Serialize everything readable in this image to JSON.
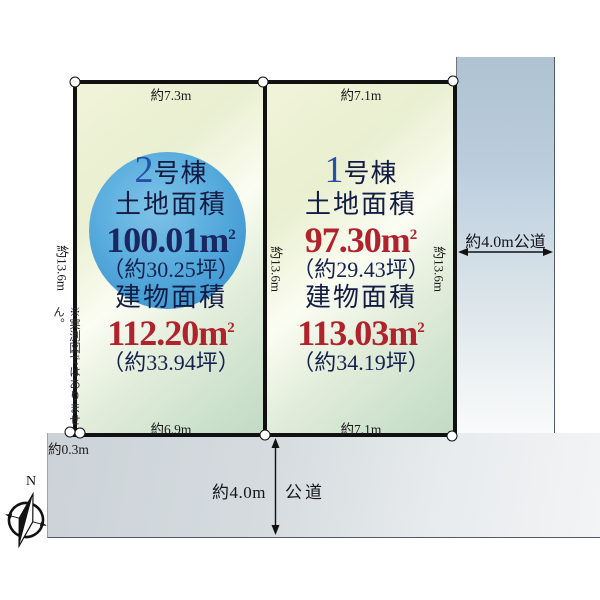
{
  "compass": {
    "north_label": "N"
  },
  "disclaimer": "※実測図ではありません。",
  "dimensions": {
    "plot2_top": "約7.3m",
    "plot1_top": "約7.1m",
    "plot2_bottom": "約6.9m",
    "plot1_bottom": "約7.1m",
    "side_left": "約13.6m",
    "side_middle": "約13.6m",
    "side_right": "約13.6m",
    "offset_bottom_left": "約0.3m"
  },
  "roads": {
    "right_label": "約4.0m公道",
    "bottom_width": "約4.0m",
    "bottom_name": "公道"
  },
  "units": {
    "base": "m",
    "exp": "2"
  },
  "plots": [
    {
      "number": "2",
      "suffix": "号棟",
      "land_label": "土地面積",
      "land_value": "100.01",
      "land_tsubo": "（約30.25坪）",
      "building_label": "建物面積",
      "building_value": "112.20",
      "building_tsubo": "（約33.94坪）"
    },
    {
      "number": "1",
      "suffix": "号棟",
      "land_label": "土地面積",
      "land_value": "97.30",
      "land_tsubo": "（約29.43坪）",
      "building_label": "建物面積",
      "building_value": "113.03",
      "building_tsubo": "（約34.19坪）"
    }
  ],
  "colors": {
    "navy_text": "#1b2760",
    "red_value": "#b1232c",
    "number_blue": "#2552a8",
    "circle_blue": "#4aa4d9",
    "plot_border": "#111111",
    "road_gray": "#ccd3d8",
    "road_blue": "#aec2d2"
  }
}
